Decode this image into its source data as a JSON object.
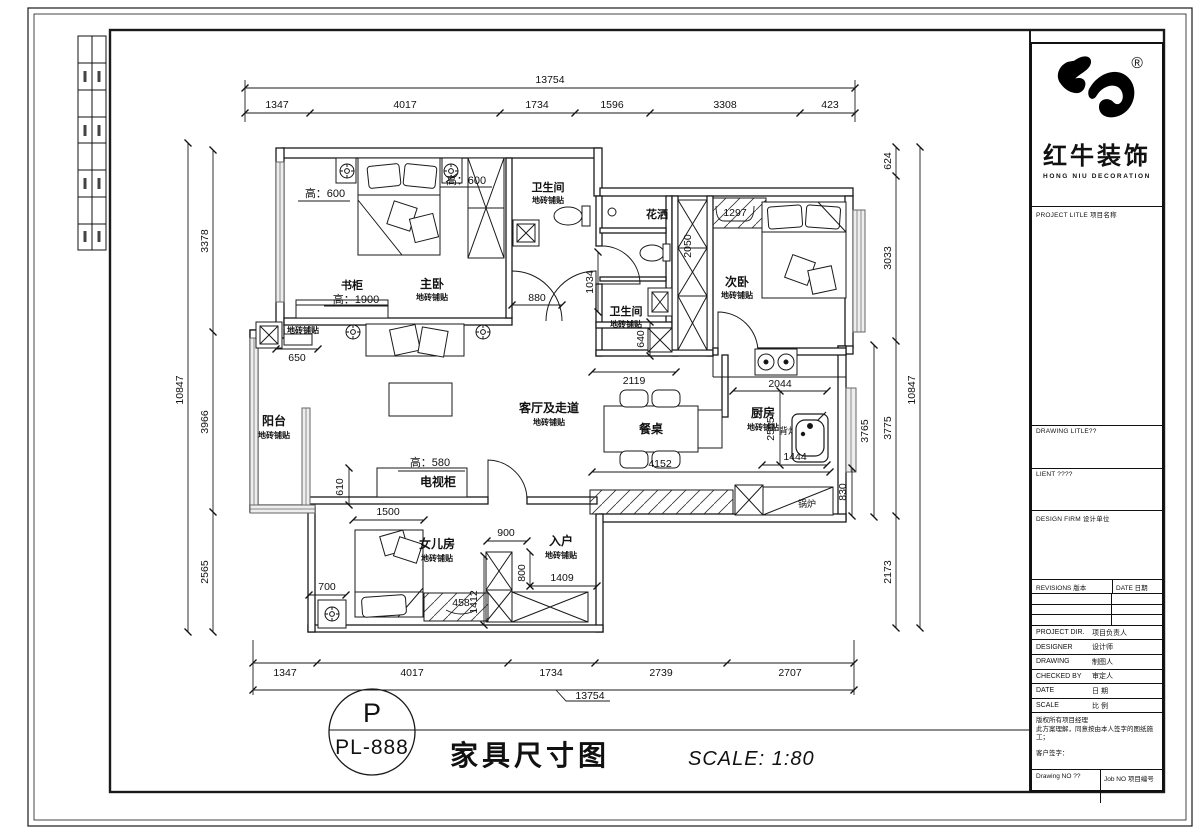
{
  "sheet": {
    "letter": "P",
    "code": "PL-888",
    "title": "家具尺寸图",
    "scale": "SCALE: 1:80"
  },
  "brand": {
    "cn": "红牛装饰",
    "en": "HONG NIU DECORATION",
    "reg": "®"
  },
  "title_block": {
    "project_title": "PROJECT LITLE 项目名称",
    "drawing_title": "DRAWING LITLE??",
    "client": "LIENT ????",
    "design_firm": "DESIGN FIRM 设计单位",
    "revisions": "REVISIONS 版本",
    "revisions_date": "DATE 日期",
    "rows": [
      {
        "en": "PROJECT DIR.",
        "cn": "项目负责人"
      },
      {
        "en": "DESIGNER",
        "cn": "设计师"
      },
      {
        "en": "DRAWING",
        "cn": "制图人"
      },
      {
        "en": "CHECKED BY",
        "cn": "审定人"
      },
      {
        "en": "DATE",
        "cn": "日 期"
      },
      {
        "en": "SCALE",
        "cn": "比 例"
      }
    ],
    "notes1": "版权所有项目经理",
    "notes2": "此方案理解，同意按由本人签字的图纸施工；",
    "notes3": "客户签字：",
    "drawing_no": "Drawing NO ??",
    "job_no": "Job NO 项目编号"
  },
  "rooms": {
    "master": {
      "name": "主卧",
      "sub": "地砖铺贴"
    },
    "bath1": {
      "name": "卫生间",
      "sub": "地砖铺贴"
    },
    "shower": {
      "name": "花洒"
    },
    "bath2": {
      "name": "卫生间",
      "sub": "地砖铺贴"
    },
    "second": {
      "name": "次卧",
      "sub": "地砖铺贴"
    },
    "balcony": {
      "name": "阳台",
      "sub": "地砖铺贴"
    },
    "living": {
      "name": "客厅及走道",
      "sub": "地砖铺贴"
    },
    "dining_table": "餐桌",
    "kitchen": {
      "name": "厨房",
      "sub": "地砖铺贴"
    },
    "tv_cabinet": "电视柜",
    "daughter": {
      "name": "女儿房",
      "sub": "地砖铺贴"
    },
    "entry": {
      "name": "入户",
      "sub": "地砖铺贴"
    },
    "boiler": "锅炉",
    "bookcase": "书柜",
    "tile": "地砖铺贴",
    "lamp": "背灯"
  },
  "heights": {
    "h600a": "高：600",
    "h600b": "高：600",
    "h1900": "高：1900",
    "h580": "高：580"
  },
  "dims": {
    "top_total": "13754",
    "top": [
      "1347",
      "4017",
      "1734",
      "1596",
      "3308",
      "423"
    ],
    "bottom": [
      "1347",
      "4017",
      "1734",
      "2739",
      "2707"
    ],
    "bottom_total": "13754",
    "left": [
      "3378",
      "3966",
      "2565"
    ],
    "left_total": "10847",
    "right": [
      "624",
      "3033",
      "3775",
      "2173"
    ],
    "right_total": "10847",
    "inner": {
      "d880": "880",
      "d1034": "1034",
      "d650": "650",
      "d2119": "2119",
      "d2050": "2050",
      "d1297": "1297",
      "d640": "640",
      "d2044": "2044",
      "d2565": "2565",
      "d3765": "3765",
      "d1444": "1444",
      "d830": "830",
      "d4152": "4152",
      "d610": "610",
      "d1500": "1500",
      "d900": "900",
      "d700": "700",
      "d458": "458",
      "d1412": "1412",
      "d800": "800",
      "d1409": "1409"
    }
  }
}
